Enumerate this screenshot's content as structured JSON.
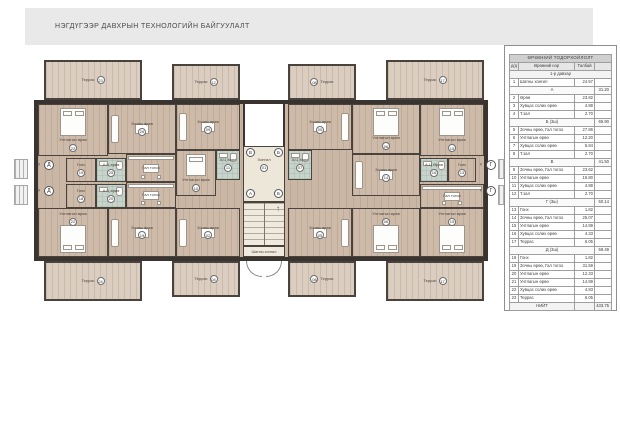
{
  "title": "НЭГДҮГЭЭР ДАВХРЫН ТЕХНОЛОГИЙН БАЙГУУЛАЛТ",
  "colors": {
    "wall": "#3a3431",
    "wood_floor": "#c9b6a4",
    "terrace_floor": "#dbcec0",
    "corridor_floor": "#ece7d8",
    "tile_floor": "#c6d4cb",
    "header_band": "#e9e9e9"
  },
  "plan": {
    "core": {
      "corridor_label": "Хонгил",
      "corridor_num": "01",
      "stair_label": "Шатны хонгил",
      "markers_top": [
        "В",
        "Б"
      ],
      "markers_bottom": [
        "А",
        "Б"
      ],
      "stair_arrow": "↑"
    },
    "axis": {
      "left": "Д",
      "right": "Г",
      "arrow_left": "›",
      "arrow_right": "‹"
    },
    "rooms": [
      {
        "id": "terrace-23",
        "label": "Террас",
        "num": "23",
        "kind": "terrace",
        "x": 14,
        "y": 2,
        "w": 98,
        "h": 40
      },
      {
        "id": "terrace-12",
        "label": "Террас",
        "num": "12",
        "kind": "terrace",
        "x": 142,
        "y": 6,
        "w": 68,
        "h": 36
      },
      {
        "id": "terrace-08-top",
        "label": "Террас",
        "num": "08",
        "numFirst": true,
        "kind": "terrace",
        "x": 258,
        "y": 6,
        "w": 68,
        "h": 36
      },
      {
        "id": "terrace-17-top",
        "label": "Террас",
        "num": "17",
        "kind": "terrace",
        "x": 356,
        "y": 2,
        "w": 98,
        "h": 40
      },
      {
        "id": "terrace-24",
        "label": "Террас",
        "num": "24",
        "kind": "terrace",
        "x": 14,
        "y": 203,
        "w": 98,
        "h": 40
      },
      {
        "id": "terrace-04",
        "label": "Террас",
        "num": "04",
        "kind": "terrace",
        "x": 142,
        "y": 203,
        "w": 68,
        "h": 36
      },
      {
        "id": "terrace-08-bottom",
        "label": "Террас",
        "num": "08",
        "numFirst": true,
        "kind": "terrace",
        "x": 258,
        "y": 203,
        "w": 68,
        "h": 36
      },
      {
        "id": "terrace-17-bottom",
        "label": "Террас",
        "num": "17",
        "kind": "terrace",
        "x": 356,
        "y": 203,
        "w": 98,
        "h": 40
      },
      {
        "id": "bedroom-22-top",
        "label": "Унтлагын өрөө",
        "num": "22",
        "kind": "wood",
        "furn": "bed-n",
        "x": 8,
        "y": 46,
        "w": 70,
        "h": 52
      },
      {
        "id": "living-26",
        "label": "Зочны өрөө",
        "num": "26",
        "kind": "wood",
        "furn": "sofa-w",
        "x": 78,
        "y": 46,
        "w": 68,
        "h": 50
      },
      {
        "id": "living-09",
        "label": "Зочны өрөө",
        "num": "09",
        "kind": "wood",
        "furn": "sofa-w",
        "x": 146,
        "y": 46,
        "w": 64,
        "h": 46
      },
      {
        "id": "bedroom-10",
        "label": "Унтлагын өрөө",
        "num": "10",
        "kind": "wood",
        "furn": "bed-n-sm",
        "x": 146,
        "y": 92,
        "w": 40,
        "h": 46
      },
      {
        "id": "bath-11",
        "label": "А.Ц өрөө",
        "num": "11",
        "kind": "tile",
        "furn": "bath",
        "x": 186,
        "y": 92,
        "w": 24,
        "h": 30
      },
      {
        "id": "living-05",
        "label": "Зочны өрөө",
        "num": "05",
        "kind": "wood",
        "furn": "sofa-e",
        "x": 258,
        "y": 46,
        "w": 64,
        "h": 46
      },
      {
        "id": "bath-07",
        "label": "А.Ц өрөө",
        "num": "07",
        "kind": "tile",
        "furn": "bath",
        "x": 258,
        "y": 92,
        "w": 24,
        "h": 30
      },
      {
        "id": "bedroom-06",
        "label": "Унтлагын өрөө",
        "num": "06",
        "kind": "wood",
        "furn": "bed-n",
        "x": 322,
        "y": 46,
        "w": 68,
        "h": 50
      },
      {
        "id": "bedroom-15-top",
        "label": "Унтлагын өрөө",
        "num": "15",
        "kind": "wood",
        "furn": "bed-n",
        "x": 390,
        "y": 46,
        "w": 64,
        "h": 52
      },
      {
        "id": "living-14",
        "label": "Зочны өрөө",
        "num": "14",
        "kind": "wood",
        "furn": "sofa-w",
        "x": 322,
        "y": 96,
        "w": 68,
        "h": 42
      },
      {
        "id": "entry-19",
        "label": "Гонх",
        "num": "19",
        "kind": "wood",
        "x": 36,
        "y": 100,
        "w": 30,
        "h": 24
      },
      {
        "id": "entry-18",
        "label": "Гонх",
        "num": "18",
        "kind": "wood",
        "x": 36,
        "y": 126,
        "w": 30,
        "h": 24
      },
      {
        "id": "bath-25",
        "label": "А.Ц өрөө",
        "num": "25",
        "kind": "tile",
        "furn": "bath",
        "x": 66,
        "y": 100,
        "w": 30,
        "h": 24
      },
      {
        "id": "bath-20",
        "label": "А.Ц өрөө",
        "num": "20",
        "kind": "tile",
        "furn": "bath",
        "x": 66,
        "y": 126,
        "w": 30,
        "h": 24
      },
      {
        "id": "kitchen-left-top",
        "label": "Гал тогоо",
        "kind": "wood",
        "furn": "dining",
        "x": 96,
        "y": 96,
        "w": 50,
        "h": 28
      },
      {
        "id": "kitchen-left-bottom",
        "label": "Гал тогоо",
        "kind": "wood",
        "furn": "dining",
        "x": 96,
        "y": 124,
        "w": 50,
        "h": 26
      },
      {
        "id": "bath-16",
        "label": "А.Ц Өрөө",
        "num": "16",
        "kind": "tile",
        "furn": "bath",
        "x": 390,
        "y": 100,
        "w": 28,
        "h": 24
      },
      {
        "id": "entry-13",
        "label": "Гонх",
        "num": "13",
        "kind": "wood",
        "x": 418,
        "y": 100,
        "w": 28,
        "h": 24
      },
      {
        "id": "kitchen-right",
        "label": "Гал тогоо",
        "kind": "wood",
        "furn": "dining",
        "x": 390,
        "y": 126,
        "w": 64,
        "h": 24
      },
      {
        "id": "bedroom-22-bottom",
        "label": "Унтлагын өрөө",
        "num": "22",
        "kind": "wood",
        "furn": "bed-s",
        "x": 8,
        "y": 150,
        "w": 70,
        "h": 49
      },
      {
        "id": "living-19",
        "label": "Зочны өрөө",
        "num": "19",
        "kind": "wood",
        "furn": "sofa-w",
        "x": 78,
        "y": 150,
        "w": 68,
        "h": 49
      },
      {
        "id": "living-02",
        "label": "Зочны өрөө",
        "num": "02",
        "kind": "wood",
        "furn": "sofa-w",
        "x": 146,
        "y": 150,
        "w": 64,
        "h": 49
      },
      {
        "id": "living-05-bottom",
        "label": "Зочны өрөө",
        "num": "05",
        "kind": "wood",
        "furn": "sofa-e",
        "x": 258,
        "y": 150,
        "w": 64,
        "h": 49
      },
      {
        "id": "bedroom-06-bottom",
        "label": "Унтлагын өрөө",
        "num": "06",
        "kind": "wood",
        "furn": "bed-s",
        "x": 322,
        "y": 150,
        "w": 68,
        "h": 49
      },
      {
        "id": "bedroom-15-bottom",
        "label": "Унтлагын өрөө",
        "num": "15",
        "kind": "wood",
        "furn": "bed-s",
        "x": 390,
        "y": 150,
        "w": 64,
        "h": 49
      }
    ]
  },
  "table": {
    "title": "ӨРӨӨНИЙ ТОДОРХОЙЛОЛТ",
    "columns": [
      "д/д",
      "Өрөөний нэр",
      "Талбай",
      ""
    ],
    "floor_header": "1-р давхар",
    "rows": [
      {
        "no": "1",
        "name": "Шатны хонгил",
        "area": "24.57"
      },
      {
        "section": "А",
        "subtotal": "31.20"
      },
      {
        "no": "2",
        "name": "Өрөө",
        "area": "23.82"
      },
      {
        "no": "3",
        "name": "Хувцас солих өрөө",
        "area": "4.88"
      },
      {
        "no": "4",
        "name": "Т.зал",
        "area": "2.70"
      },
      {
        "section": "Б (3ш)",
        "subtotal": "65.90"
      },
      {
        "no": "5",
        "name": "Зочны өрөө, Гал тогоо",
        "area": "27.86"
      },
      {
        "no": "6",
        "name": "Унтлагын өрөө",
        "area": "12.20"
      },
      {
        "no": "7",
        "name": "Хувцас солих өрөө",
        "area": "5.84"
      },
      {
        "no": "8",
        "name": "Т.зал",
        "area": "2.70"
      },
      {
        "section": "В",
        "subtotal": "41.50"
      },
      {
        "no": "9",
        "name": "Зочны өрөө, Гал тогоо",
        "area": "23.62"
      },
      {
        "no": "10",
        "name": "Унтлагын өрөө",
        "area": "15.80"
      },
      {
        "no": "11",
        "name": "Хувцас солих өрөө",
        "area": "4.88"
      },
      {
        "no": "12",
        "name": "Т.зал",
        "area": "2.70"
      },
      {
        "section": "Г (3ш)",
        "subtotal": "50.14"
      },
      {
        "no": "13",
        "name": "Гонх",
        "area": "1.82"
      },
      {
        "no": "14",
        "name": "Зочны өрөө, Гал тогоо",
        "area": "25.07"
      },
      {
        "no": "15",
        "name": "Унтлагын өрөө",
        "area": "14.89"
      },
      {
        "no": "16",
        "name": "Хувцас солих өрөө",
        "area": "4.33"
      },
      {
        "no": "17",
        "name": "Террас",
        "area": "6.05"
      },
      {
        "section": "Д (3ш)",
        "subtotal": "59.49"
      },
      {
        "no": "18",
        "name": "Гонх",
        "area": "1.82"
      },
      {
        "no": "19",
        "name": "Зочны өрөө, Гал тогоо",
        "area": "31.59"
      },
      {
        "no": "20",
        "name": "Унтлагын өрөө",
        "area": "12.33"
      },
      {
        "no": "21",
        "name": "Унтлагын өрөө",
        "area": "14.89"
      },
      {
        "no": "22",
        "name": "Хувцас солих өрөө",
        "area": "4.83"
      },
      {
        "no": "23",
        "name": "Террас",
        "area": "6.05"
      }
    ],
    "total_label": "НИЙТ",
    "total": "433.75"
  }
}
